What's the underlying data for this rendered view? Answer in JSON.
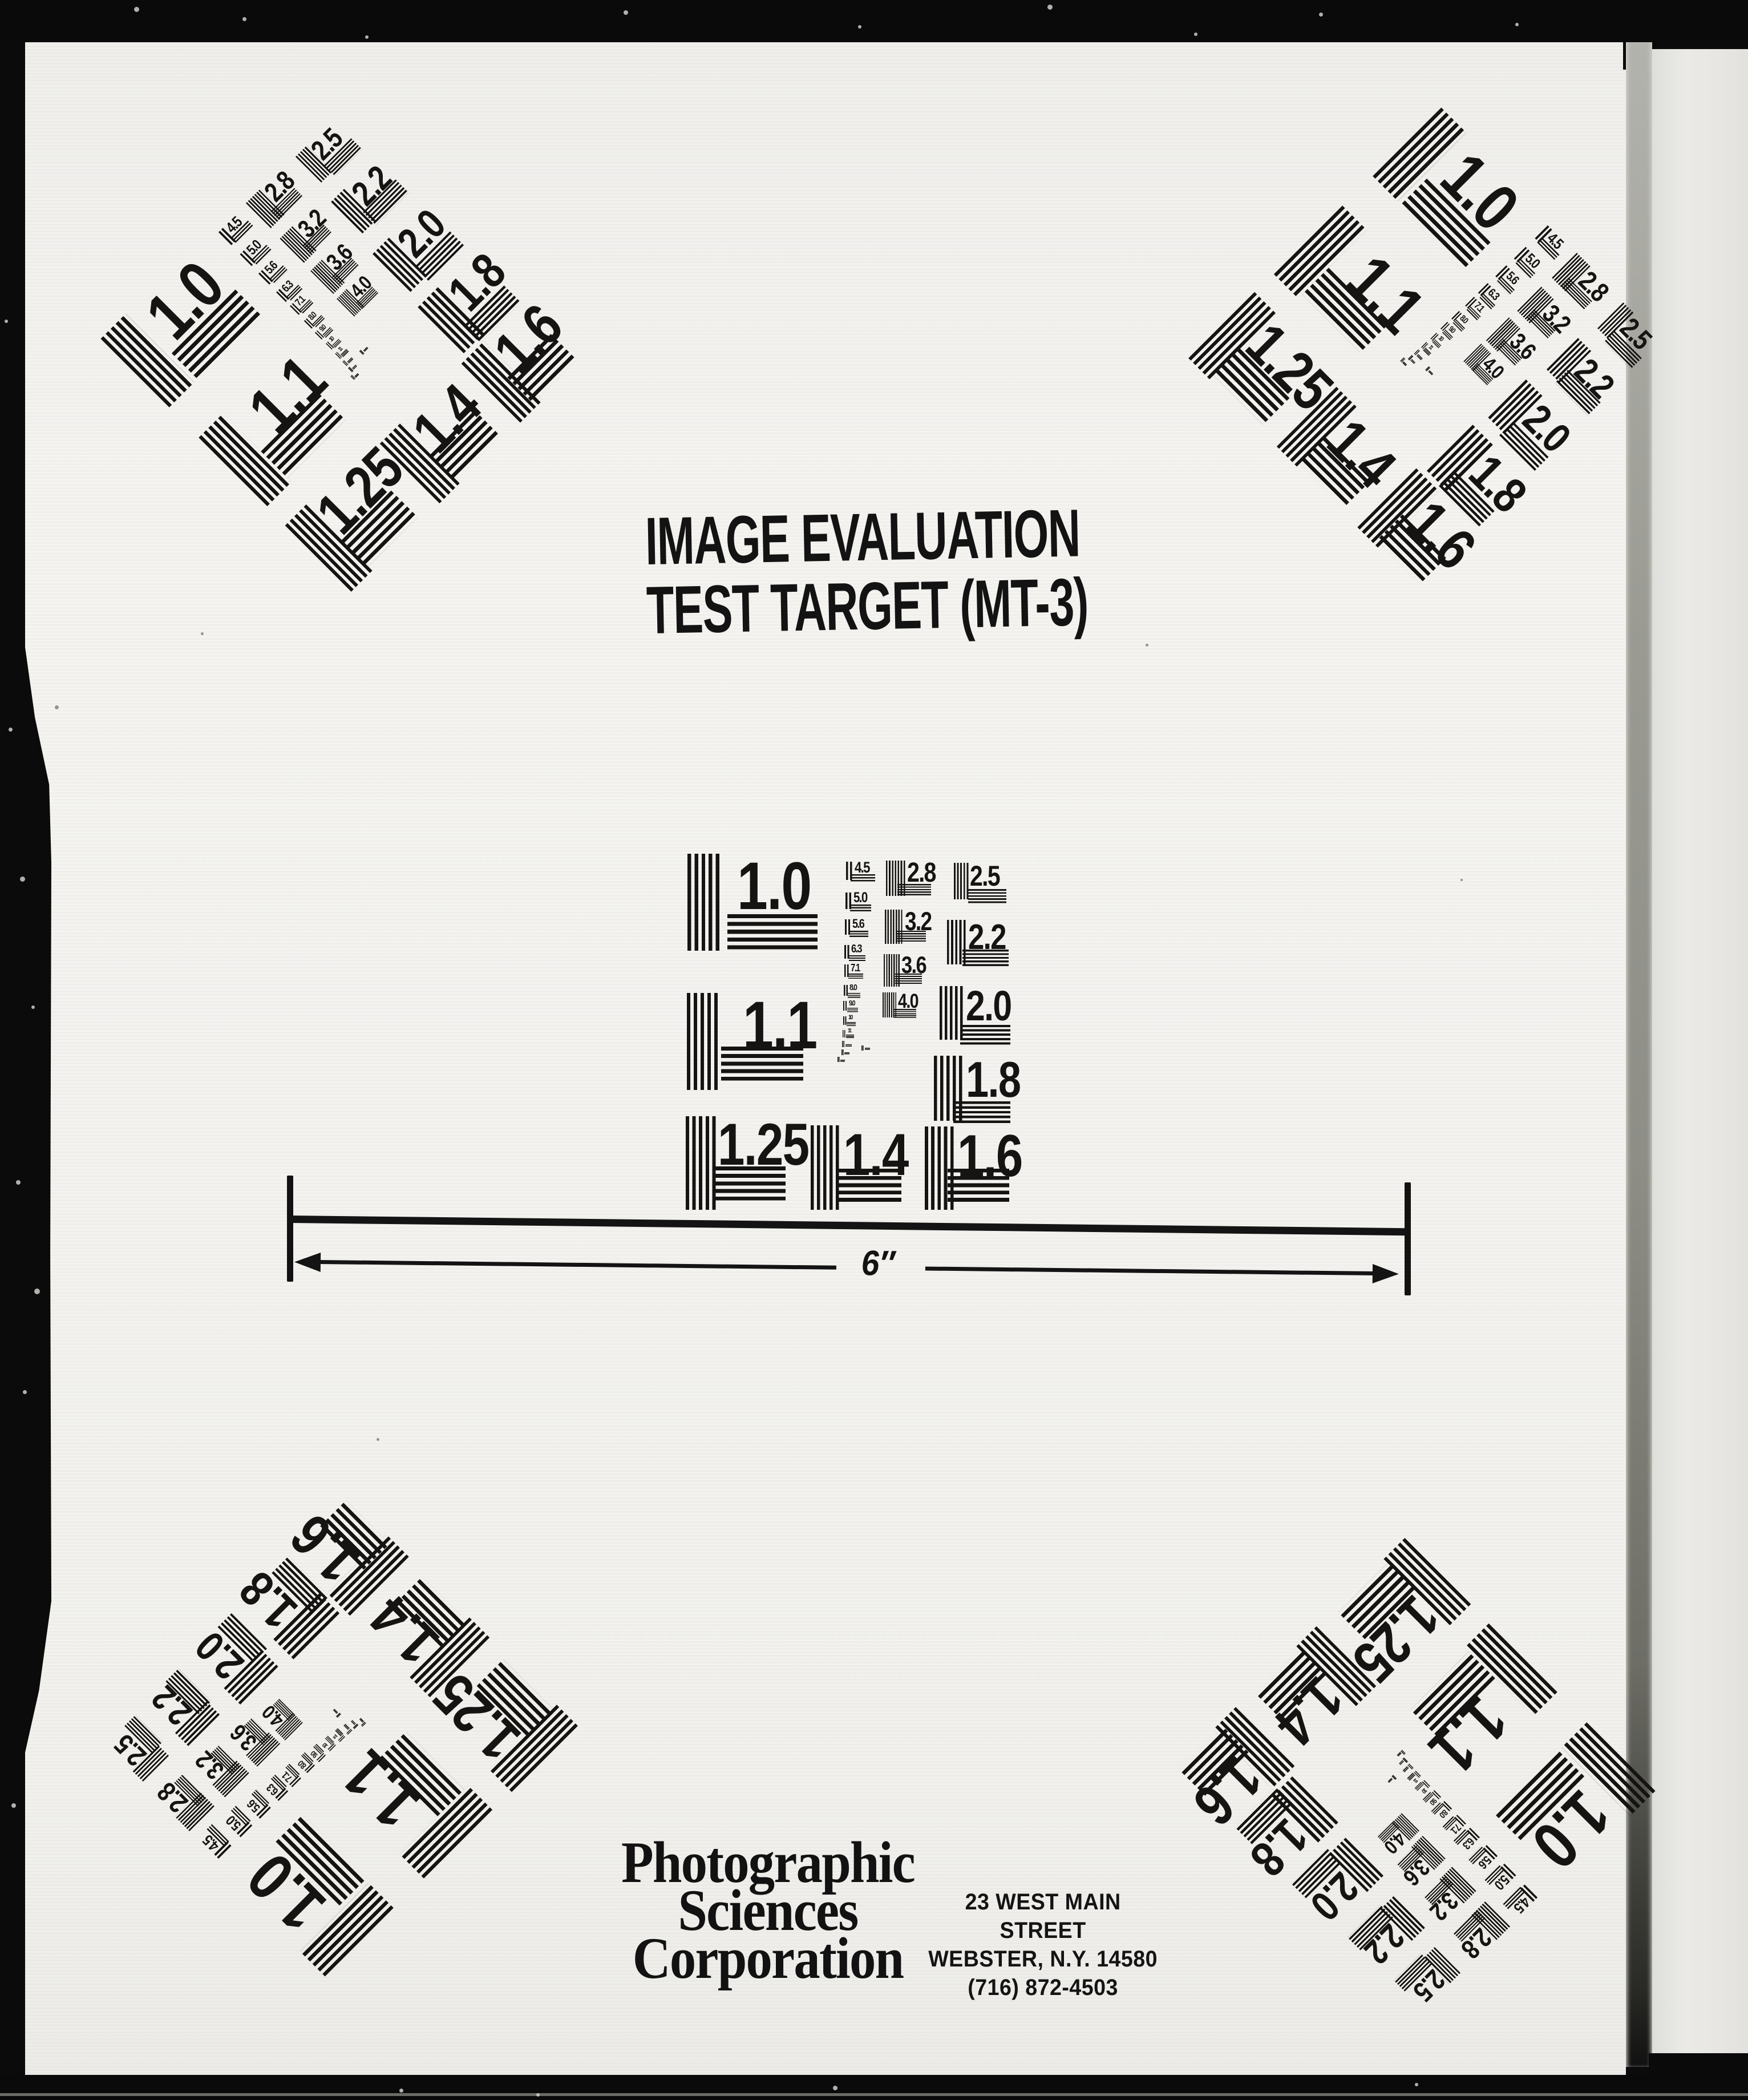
{
  "document": {
    "title_line1": "IMAGE EVALUATION",
    "title_line2": "TEST TARGET (MT-3)",
    "scale_label": "6″",
    "company": {
      "line1": "Photographic",
      "line2": "Sciences",
      "line3": "Corporation"
    },
    "address": {
      "line1": "23 WEST MAIN STREET",
      "line2": "WEBSTER, N.Y. 14580",
      "line3": "(716) 872-4503"
    }
  },
  "test_patch": {
    "large_labels": [
      "1.0",
      "1.1",
      "1.25",
      "1.4",
      "1.6",
      "1.8",
      "2.0",
      "2.2",
      "2.5"
    ],
    "medium_labels": [
      "2.8",
      "3.2",
      "3.6",
      "4.0"
    ],
    "small_labels": [
      "4.5",
      "5.0",
      "5.6",
      "6.3",
      "7.1",
      "8.0",
      "9.0",
      "10",
      "11"
    ]
  },
  "patches": [
    "center",
    "top-left",
    "top-right",
    "bottom-left",
    "bottom-right"
  ],
  "colors": {
    "ink": "#161412",
    "paper": "#f4f3f0",
    "scanner_background": "#0a0a0a",
    "adjacent_page": "#e7e6e3",
    "page_edge": "#8e8e87"
  }
}
